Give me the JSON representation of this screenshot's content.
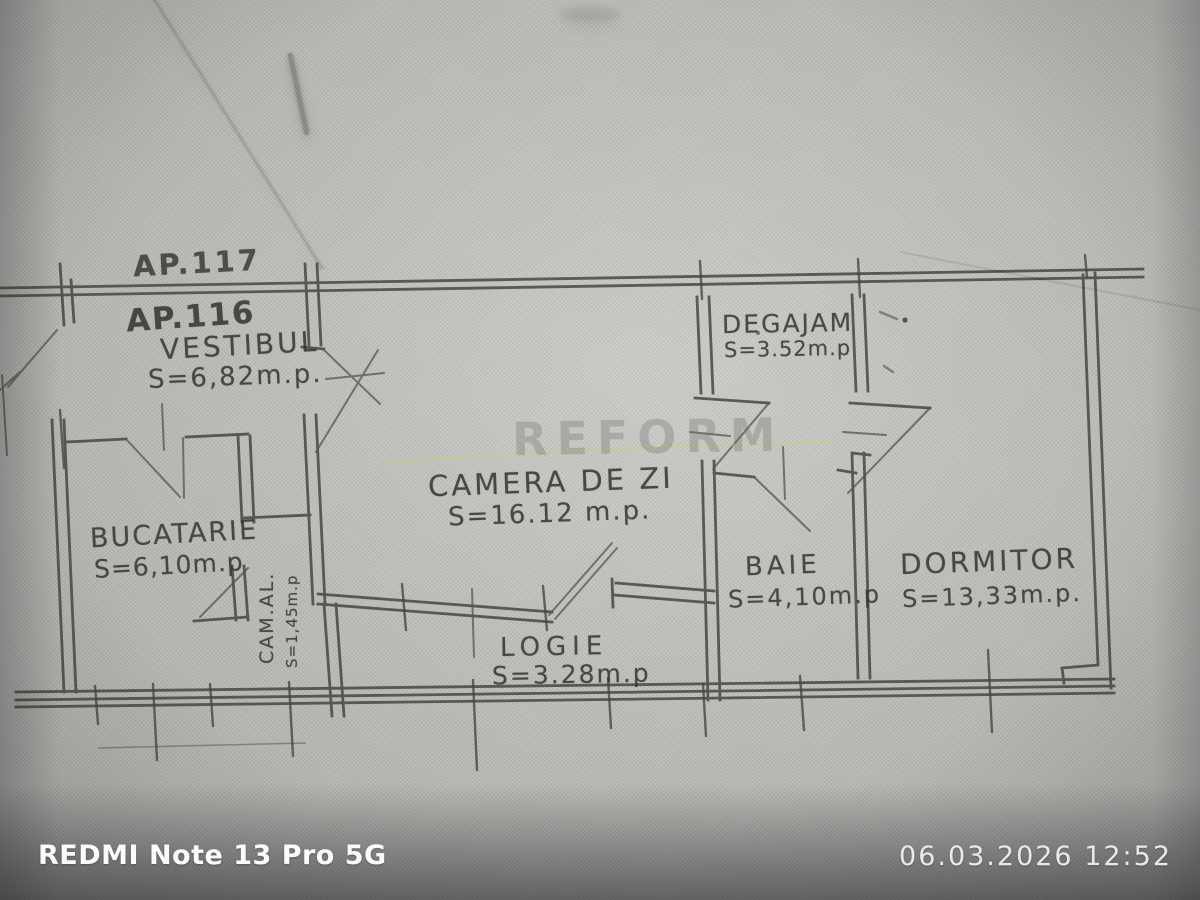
{
  "photo": {
    "camera_watermark": "REDMI Note 13 Pro 5G",
    "timestamp_watermark": "06.03.2026 12:52"
  },
  "floorplan": {
    "apartment_label": "AP.116",
    "adjacent_apartment_label": "AP.117",
    "stamp_watermark": "REFORM",
    "rooms": [
      {
        "id": "vestibul",
        "name": "VESTIBUL",
        "area": "S=6,82m.p."
      },
      {
        "id": "degajament",
        "name": "DEGAJAM",
        "area": "S=3.52m.p"
      },
      {
        "id": "camera-de-zi",
        "name": "CAMERA DE ZI",
        "area": "S=16.12 m.p."
      },
      {
        "id": "bucatarie",
        "name": "BUCATARIE",
        "area": "S=6,10m.p"
      },
      {
        "id": "camara-alimente",
        "name": "CAM.AL.",
        "area": "S=1,45m.p"
      },
      {
        "id": "baie",
        "name": "BAIE",
        "area": "S=4,10m.p"
      },
      {
        "id": "dormitor",
        "name": "DORMITOR",
        "area": "S=13,33m.p."
      },
      {
        "id": "logie",
        "name": "LOGIE",
        "area": "S=3.28m.p"
      }
    ]
  }
}
